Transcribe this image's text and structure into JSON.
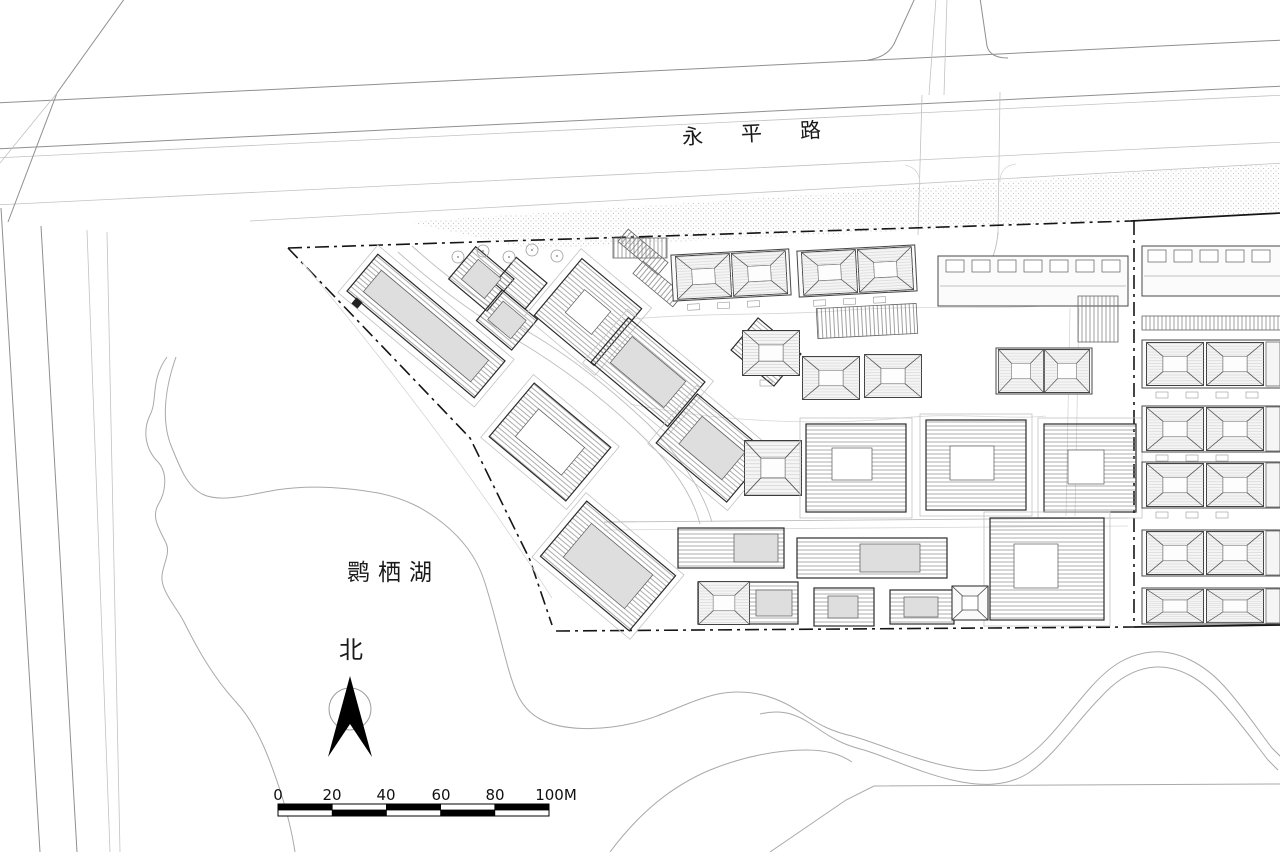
{
  "map": {
    "road_label": "永平路",
    "lake_label": "鹮栖湖",
    "north_label": "北",
    "scale_bar": {
      "labels": [
        "0",
        "20",
        "40",
        "60",
        "80",
        "100M"
      ]
    },
    "colors": {
      "paper": "#ffffff",
      "ink_dark": "#151515",
      "ink_mid": "#666666",
      "ink_light": "#aaaaaa",
      "building_fill": "#dedede",
      "roof_fill": "#f5f5f5"
    }
  }
}
